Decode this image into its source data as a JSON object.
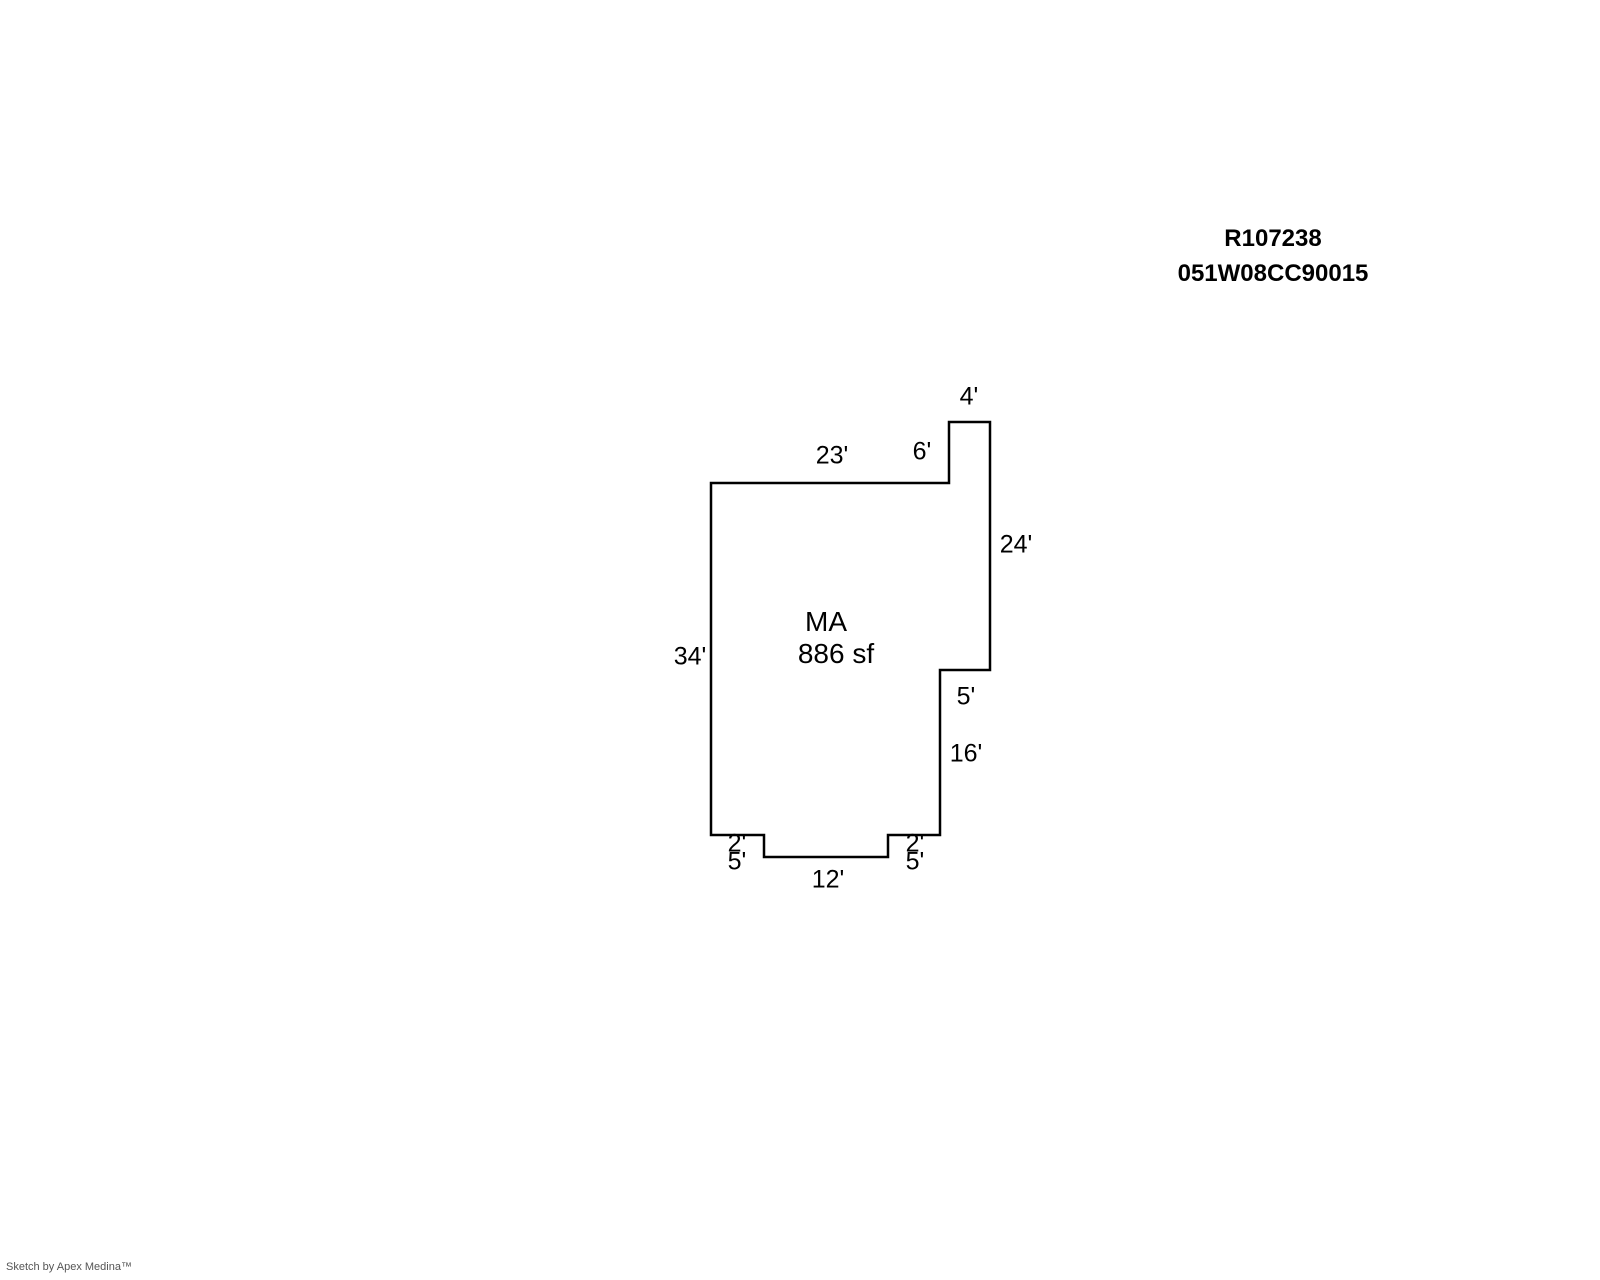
{
  "header": {
    "record_id": "R107238",
    "parcel_number": "051W08CC90015"
  },
  "sketch": {
    "room": {
      "code": "MA",
      "area": "886 sf",
      "code_x": 826,
      "code_y": 622,
      "area_x": 836,
      "area_y": 654
    },
    "outline_px": [
      [
        711,
        483
      ],
      [
        949,
        483
      ],
      [
        949,
        422
      ],
      [
        990,
        422
      ],
      [
        990,
        670
      ],
      [
        940,
        670
      ],
      [
        940,
        835
      ],
      [
        888,
        835
      ],
      [
        888,
        857
      ],
      [
        764,
        857
      ],
      [
        764,
        835
      ],
      [
        711,
        835
      ]
    ],
    "outline_stroke_width": 2.5,
    "dimensions": [
      {
        "label": "4'",
        "x": 969,
        "y": 397
      },
      {
        "label": "23'",
        "x": 832,
        "y": 456
      },
      {
        "label": "6'",
        "x": 922,
        "y": 452
      },
      {
        "label": "24'",
        "x": 1016,
        "y": 545
      },
      {
        "label": "34'",
        "x": 690,
        "y": 657
      },
      {
        "label": "5'",
        "x": 966,
        "y": 697
      },
      {
        "label": "16'",
        "x": 966,
        "y": 754
      },
      {
        "label": "2'",
        "x": 737,
        "y": 844
      },
      {
        "label": "5'",
        "x": 737,
        "y": 862
      },
      {
        "label": "2'",
        "x": 915,
        "y": 844
      },
      {
        "label": "5'",
        "x": 915,
        "y": 862
      },
      {
        "label": "12'",
        "x": 828,
        "y": 880
      }
    ]
  },
  "footer": {
    "credit": "Sketch by Apex Medina™"
  },
  "colors": {
    "line": "#000000",
    "text": "#000000",
    "footer_text": "#555555",
    "background": "#ffffff"
  }
}
